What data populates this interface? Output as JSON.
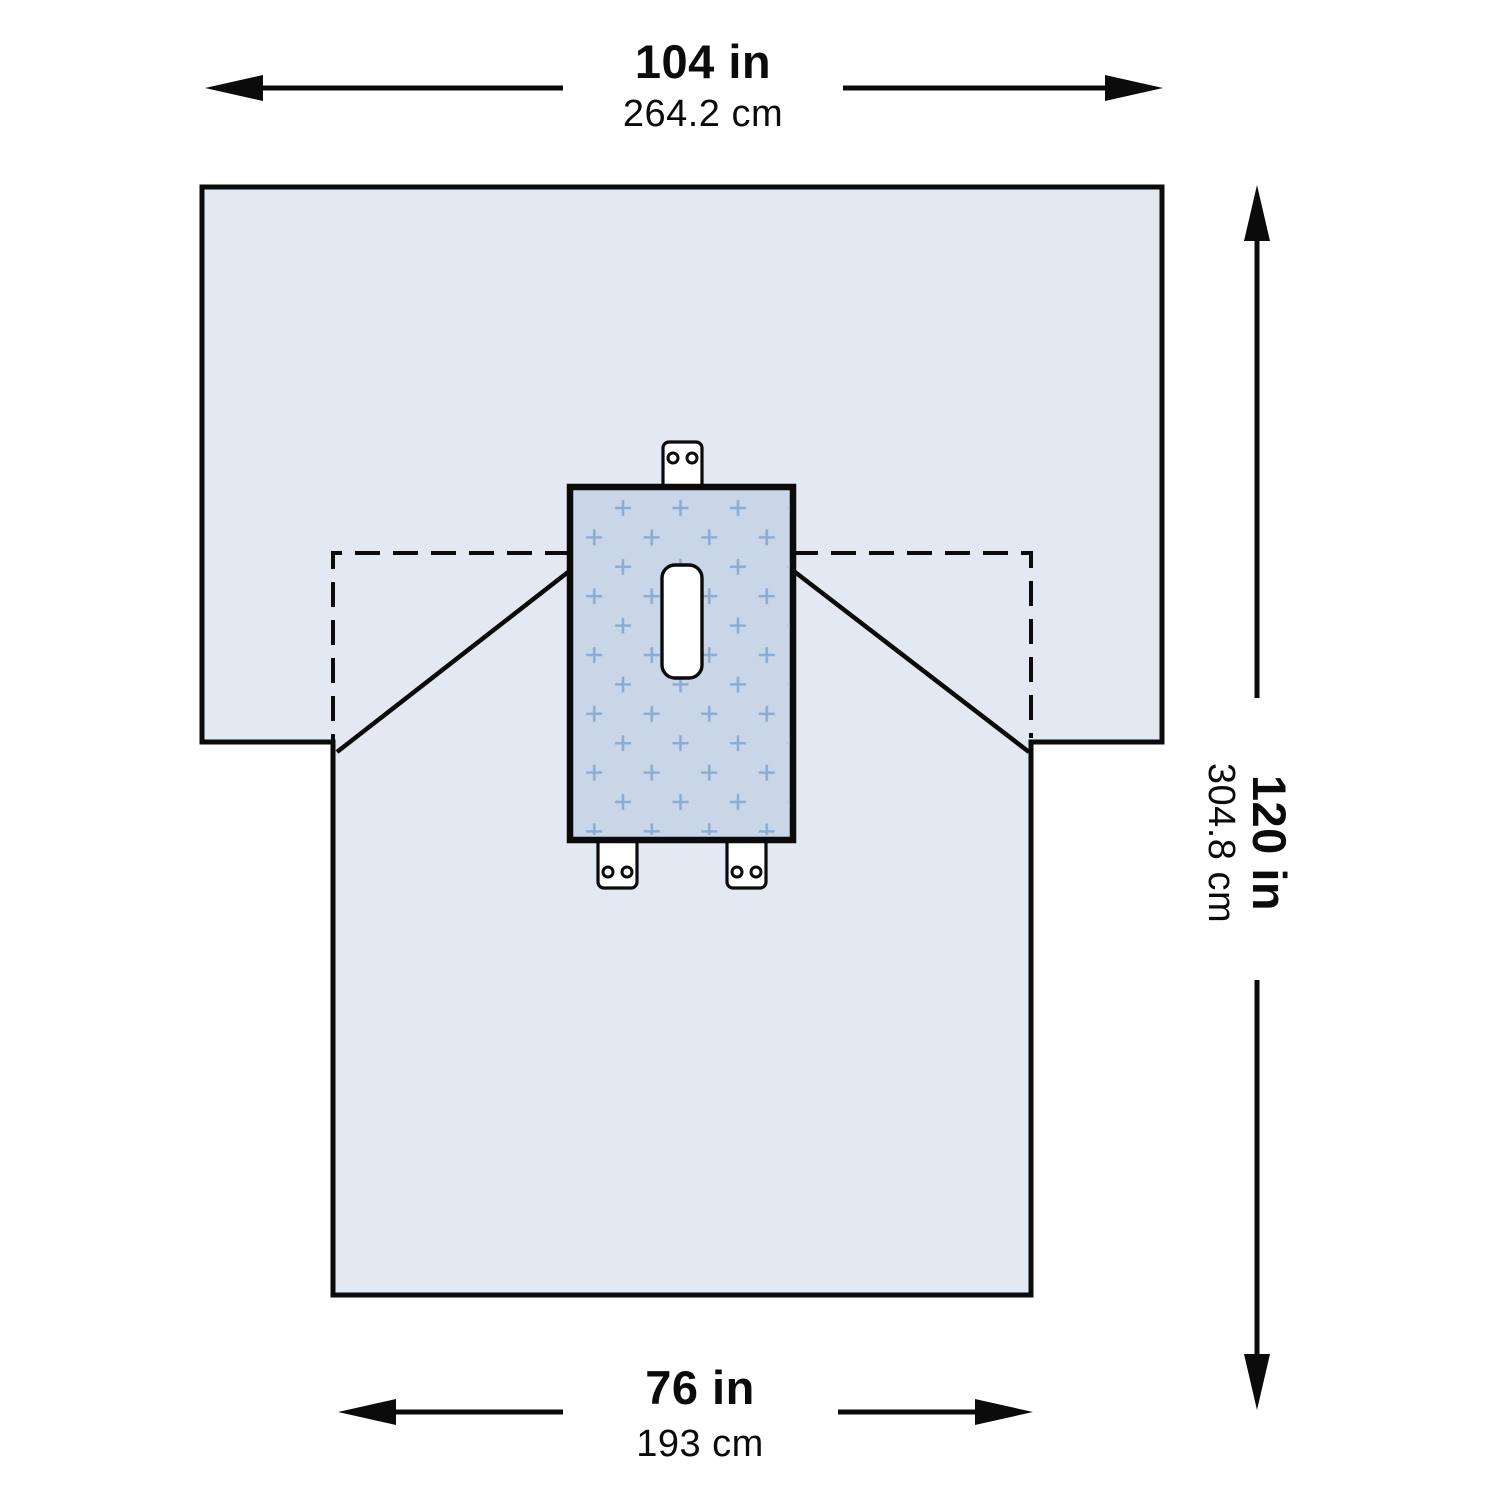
{
  "diagram": {
    "type": "product-dimension-diagram",
    "subject": "surgical-drape-with-fenestration",
    "dimensions": {
      "top_width": {
        "inches": "104 in",
        "metric": "264.2 cm"
      },
      "right_height": {
        "inches": "120 in",
        "metric": "304.8 cm"
      },
      "bottom_width": {
        "inches": "76 in",
        "metric": "193 cm"
      }
    },
    "colors": {
      "drape_fill": "#e3e9f3",
      "reinforcement_fill": "#c8d6e7",
      "cross_pattern": "#8cadd3",
      "fenestration_fill": "#ffffff",
      "tab_fill": "#ffffff",
      "line": "#0b0b0b"
    }
  }
}
